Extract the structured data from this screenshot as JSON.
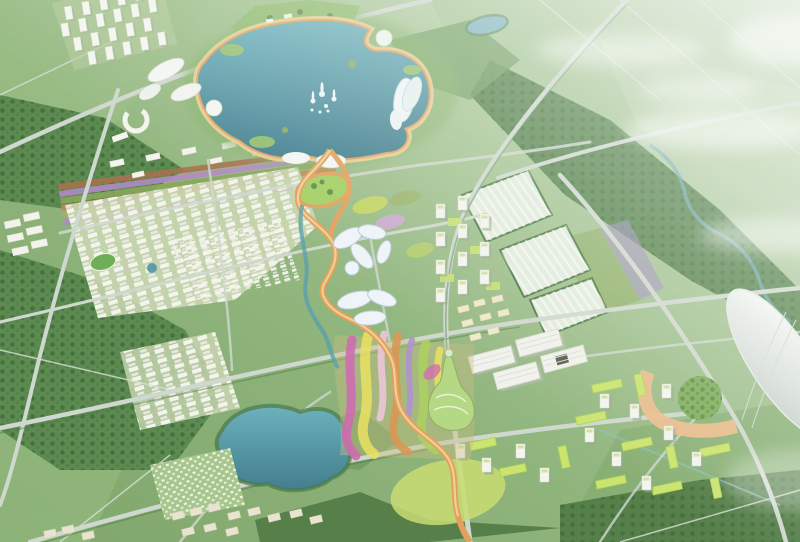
{
  "scene": {
    "type": "aerial-masterplan-rendering",
    "regions": [
      {
        "id": "central-lake",
        "label": "central lake with fountains"
      },
      {
        "id": "lake-promenade",
        "label": "orange lakeside promenade"
      },
      {
        "id": "lakeside-pavilions",
        "label": "white organic lakeside pavilions"
      },
      {
        "id": "tower-cluster-nw",
        "label": "high-rise tower cluster"
      },
      {
        "id": "residential-grid-west",
        "label": "residential block grid"
      },
      {
        "id": "crop-strips",
        "label": "colored agricultural strips"
      },
      {
        "id": "spine-park",
        "label": "winding orange spine park"
      },
      {
        "id": "petal-buildings",
        "label": "petal shaped glass buildings"
      },
      {
        "id": "flower-gardens",
        "label": "swirling flower terraces"
      },
      {
        "id": "gourd-tower",
        "label": "organic landmark tower"
      },
      {
        "id": "greenhouse-band",
        "label": "greenhouse field band"
      },
      {
        "id": "office-towers-east",
        "label": "mid-rise office towers"
      },
      {
        "id": "industrial-halls",
        "label": "white industrial halls"
      },
      {
        "id": "campus-southeast",
        "label": "lime roof campus"
      },
      {
        "id": "shell-dome",
        "label": "white shell exhibition dome"
      },
      {
        "id": "south-lake",
        "label": "second lake"
      },
      {
        "id": "villa-cluster",
        "label": "low villa cluster"
      },
      {
        "id": "forest",
        "label": "forest belts"
      },
      {
        "id": "farmland-haze",
        "label": "hazy farmland with clouds"
      }
    ]
  },
  "palette": {
    "field": "#8fb47c",
    "fieldLight": "#a9c794",
    "fieldPale": "#cfe0c4",
    "forest": "#4f7d45",
    "forestDark": "#3e6b39",
    "forestLight": "#6d9a5c",
    "water": "#5899a9",
    "waterDeep": "#41798b",
    "waterLight": "#79b7c1",
    "road": "#cfd8cf",
    "roadMinor": "#dde4da",
    "building": "#f5f6f0",
    "buildingShade": "#9fb28f",
    "buildingEdge": "#d9dcd2",
    "beige": "#e9e4d0",
    "lime": "#c8e172",
    "limeDark": "#a9cd4f",
    "spine": "#e2a05c",
    "spineLight": "#f0cf96",
    "parkGreen": "#8cbf63",
    "lawn": "#c9dc72",
    "gardenMagenta": "#cf6fb0",
    "gardenYellow": "#e6df63",
    "gardenBlush": "#ecc7d6",
    "gardenOrange": "#d99a56",
    "gardenViolet": "#b095cf",
    "gardenLime": "#aed162",
    "crop1": "#a8724f",
    "crop2": "#b18bc4",
    "crop3": "#8aa85c",
    "crop4": "#c08a5a",
    "crop5": "#9db36a",
    "plaza": "#ecbd8d",
    "dome": "#eef1ee",
    "domeShade": "#c2ccc6",
    "haze": "#eef4ec",
    "mint": "#e3ecdd",
    "cream": "#efe9c8",
    "petal": "#eef4f8",
    "petalEdge": "#b9cdd8"
  }
}
